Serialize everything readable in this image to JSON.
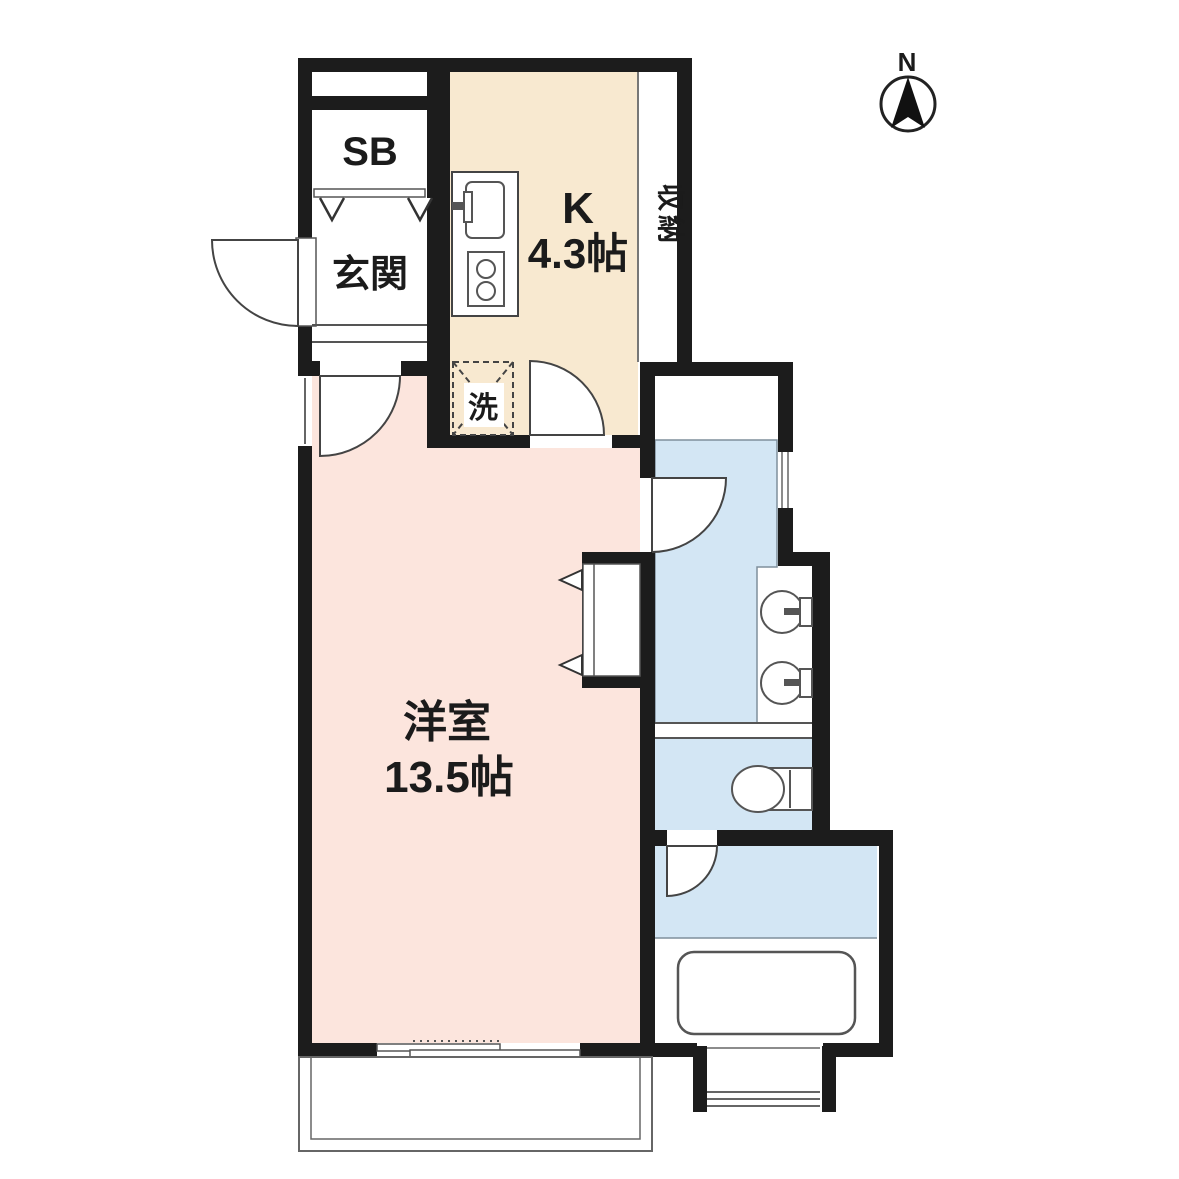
{
  "compass": {
    "north_label": "N"
  },
  "labels": {
    "shoe_box": "SB",
    "entrance": "玄関",
    "kitchen": "K",
    "kitchen_size": "4.3帖",
    "storage": "収納",
    "laundry": "洗",
    "western_room": "洋室",
    "western_room_size": "13.5帖"
  },
  "colors": {
    "wall": "#1c1c1c",
    "kitchen_floor": "#f8e9d0",
    "western_room_floor": "#fce5dd",
    "wet_area_floor": "#d3e6f4",
    "background": "#ffffff"
  }
}
